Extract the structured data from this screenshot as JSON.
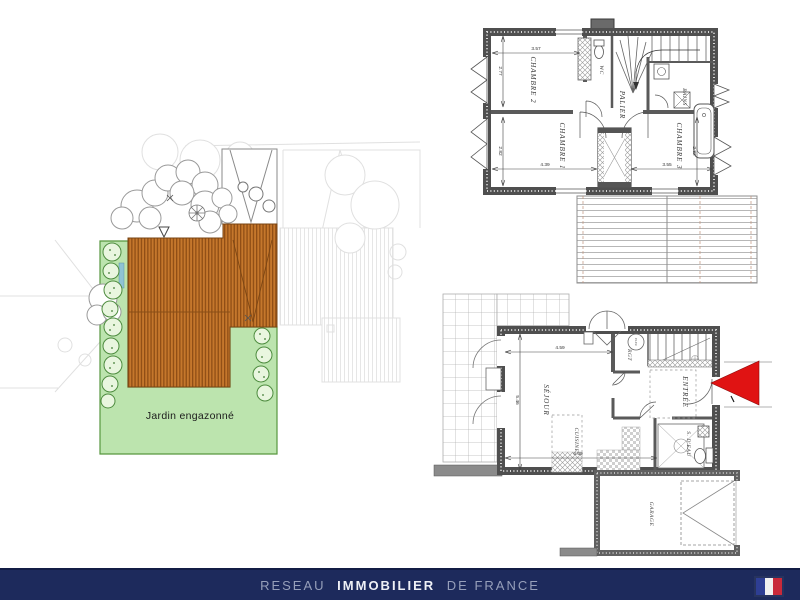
{
  "site_plan": {
    "garden_label": "Jardin engazonné"
  },
  "upper_floor": {
    "rooms": {
      "chambre2": "CHAMBRE 2",
      "chambre1": "CHAMBRE 1",
      "chambre3": "CHAMBRE 3",
      "wc": "WC",
      "palier": "PALIER",
      "bains": "BAINS"
    },
    "dims": {
      "chambre2_w": "3.57",
      "chambre2_h": "2.77",
      "chambre1_h": "2.82",
      "chambre1_w": "4.39",
      "chambre3_w": "3.55",
      "chambre3_h": "2.82"
    }
  },
  "ground_floor": {
    "rooms": {
      "sejour": "SÉJOUR",
      "cuisine": "CUISINE",
      "entree": "ENTRÉE",
      "rgt": "RGT",
      "elec": "ELEC",
      "s_deau": "S. D'EAU",
      "garage": "GARAGE"
    },
    "dims": {
      "sejour_w": "4.59",
      "sejour_h": "5.46",
      "bottom_w": "6.09"
    }
  },
  "footer": {
    "word1": "RESEAU",
    "word2": "IMMOBILIER",
    "word3": "DE FRANCE",
    "bar_color": "#1d2a5c"
  },
  "colors": {
    "roof_orange": "#c5772c",
    "roof_stripe": "#8f4e15",
    "garden_green": "#bce4ae",
    "wall_gray": "#4f4f4f",
    "arrow_red": "#e01313",
    "flag_blue": "#2e3e94",
    "flag_red": "#c8293a"
  }
}
